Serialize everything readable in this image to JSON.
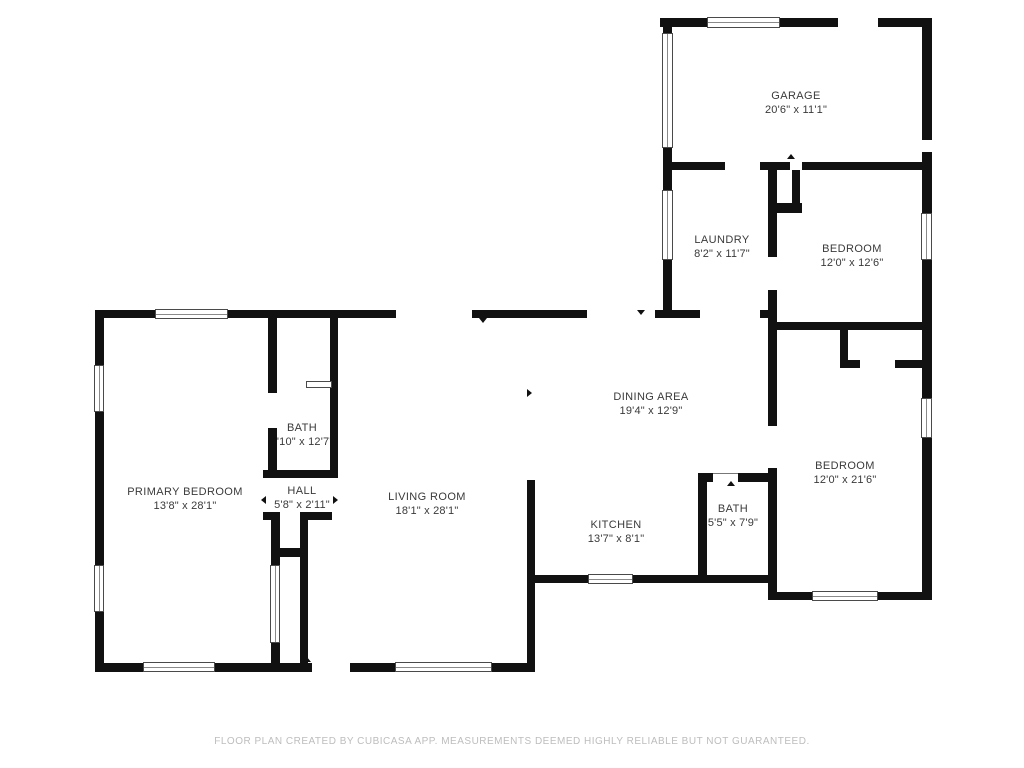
{
  "plan": {
    "rooms": [
      {
        "id": "garage",
        "name": "GARAGE",
        "dims": "20'6\" x 11'1\""
      },
      {
        "id": "laundry",
        "name": "LAUNDRY",
        "dims": "8'2\" x 11'7\""
      },
      {
        "id": "bedroom-1",
        "name": "BEDROOM",
        "dims": "12'0\" x 12'6\""
      },
      {
        "id": "dining-area",
        "name": "DINING AREA",
        "dims": "19'4\" x 12'9\""
      },
      {
        "id": "bedroom-2",
        "name": "BEDROOM",
        "dims": "12'0\" x 21'6\""
      },
      {
        "id": "kitchen",
        "name": "KITCHEN",
        "dims": "13'7\" x 8'1\""
      },
      {
        "id": "bath-2",
        "name": "BATH",
        "dims": "5'5\" x 7'9\""
      },
      {
        "id": "primary-bedroom",
        "name": "PRIMARY BEDROOM",
        "dims": "13'8\" x 28'1\""
      },
      {
        "id": "bath-1",
        "name": "BATH",
        "dims": "4'10\" x 12'7\""
      },
      {
        "id": "hall",
        "name": "HALL",
        "dims": "5'8\" x 2'11\""
      },
      {
        "id": "living-room",
        "name": "LIVING ROOM",
        "dims": "18'1\" x 28'1\""
      }
    ],
    "footer": {
      "disclaimer": "FLOOR PLAN CREATED BY CUBICASA APP. MEASUREMENTS DEEMED HIGHLY RELIABLE BUT NOT GUARANTEED."
    },
    "colors": {
      "wall": "#111111",
      "label_text": "#3a3a3a",
      "footer_text": "#bdbdbd",
      "background": "#ffffff",
      "window_frame": "#4a4a4a"
    }
  }
}
